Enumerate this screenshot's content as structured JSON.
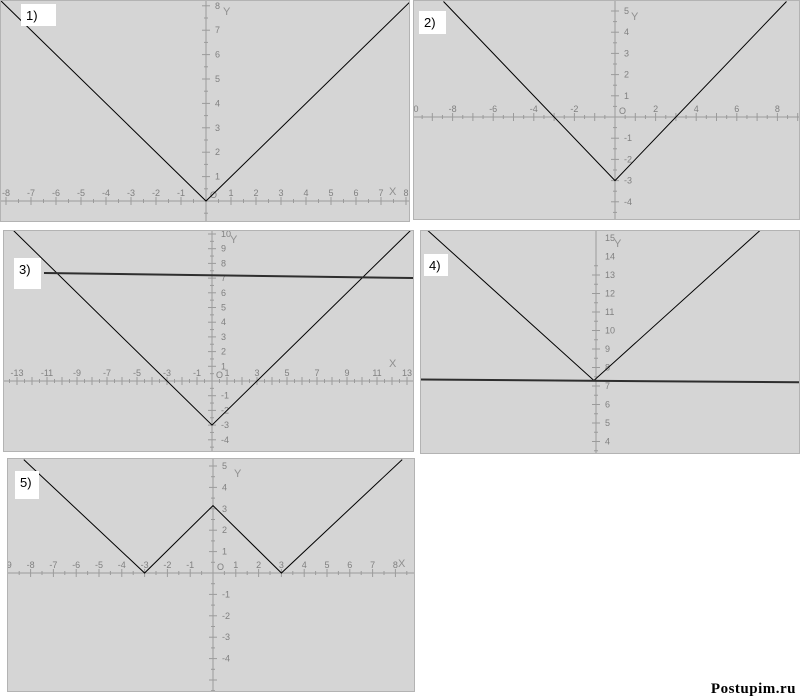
{
  "watermark": {
    "text": "Postupim.ru"
  },
  "colors": {
    "panel_bg": "#d5d5d5",
    "panel_border": "#b3b3b3",
    "axis": "#9b9b9b",
    "tick": "#9b9b9b",
    "tick_label": "#808080",
    "axis_letter": "#8f8f8f",
    "curve": "#000000",
    "thick_line": "#2e2e2e",
    "label_box_bg": "#ffffff",
    "label_text": "#000000"
  },
  "chart_data": [
    {
      "panel": "1)",
      "type": "line",
      "rect": [
        0,
        0,
        410,
        222
      ],
      "origin_px": [
        205,
        200
      ],
      "px_per_unit": [
        25,
        24.4
      ],
      "x_axis": {
        "show": true,
        "labels": [
          -8,
          -7,
          -6,
          -5,
          -4,
          -3,
          -2,
          -1,
          1,
          2,
          3,
          4,
          5,
          6,
          7,
          8
        ],
        "tick_step": 0.5,
        "letter": "X",
        "letter_px": [
          388,
          194
        ]
      },
      "y_axis": {
        "show": true,
        "labels": [
          1,
          2,
          3,
          4,
          5,
          6,
          7,
          8
        ],
        "tick_step": 0.5,
        "letter": "Y",
        "letter_px": [
          222,
          14
        ]
      },
      "origin_label": "O",
      "label_box": [
        20,
        3,
        35,
        22
      ],
      "series": [
        {
          "role": "v-curve",
          "points": [
            [
              -8.4,
              8.4
            ],
            [
              0,
              0
            ],
            [
              8.4,
              8.4
            ]
          ],
          "width": 1,
          "color": "#000000"
        }
      ]
    },
    {
      "panel": "2)",
      "type": "line",
      "rect": [
        413,
        0,
        387,
        220
      ],
      "origin_px": [
        201,
        116
      ],
      "px_per_unit": [
        20.3,
        21.2
      ],
      "x_axis": {
        "show": true,
        "labels": [
          -10,
          -8,
          -6,
          -4,
          -2,
          2,
          4,
          6,
          8
        ],
        "tick_step": 0.5,
        "letter": "",
        "letter_px": [
          0,
          0
        ]
      },
      "y_axis": {
        "show": true,
        "labels": [
          -4,
          -3,
          -2,
          -1,
          1,
          2,
          3,
          4,
          5
        ],
        "tick_step": 0.5,
        "letter": "Y",
        "letter_px": [
          217,
          19
        ]
      },
      "origin_label": "O",
      "label_box": [
        5,
        10,
        27,
        23
      ],
      "series": [
        {
          "role": "v-curve",
          "points": [
            [
              -8.45,
              5.45
            ],
            [
              0,
              -3
            ],
            [
              8.45,
              5.45
            ]
          ],
          "width": 1,
          "color": "#000000"
        }
      ]
    },
    {
      "panel": "3)",
      "type": "line",
      "rect": [
        3,
        230,
        411,
        222
      ],
      "origin_px": [
        208,
        150
      ],
      "px_per_unit": [
        15,
        14.7
      ],
      "x_axis": {
        "show": true,
        "labels": [
          -13,
          -11,
          -9,
          -7,
          -5,
          -3,
          -1,
          1,
          3,
          5,
          7,
          9,
          11,
          13
        ],
        "tick_step": 0.5,
        "letter": "X",
        "letter_px": [
          385,
          136
        ]
      },
      "y_axis": {
        "show": true,
        "labels": [
          -4,
          -3,
          -2,
          -1,
          1,
          2,
          3,
          4,
          5,
          6,
          7,
          8,
          9,
          10
        ],
        "tick_step": 0.5,
        "letter": "Y",
        "letter_px": [
          226,
          12
        ]
      },
      "origin_label": "O",
      "label_box": [
        10,
        27,
        27,
        31
      ],
      "series": [
        {
          "role": "v-curve",
          "points": [
            [
              -13.8,
              10.8
            ],
            [
              0,
              -3
            ],
            [
              13.8,
              10.8
            ]
          ],
          "width": 1,
          "color": "#000000"
        },
        {
          "role": "horizontal-line",
          "points": [
            [
              -11.2,
              7.35
            ],
            [
              13.8,
              7.0
            ]
          ],
          "width": 2,
          "color": "#2e2e2e"
        }
      ]
    },
    {
      "panel": "4)",
      "type": "line",
      "rect": [
        420,
        230,
        380,
        224
      ],
      "origin_px": [
        175,
        284.5
      ],
      "px_per_unit": [
        20.5,
        18.5
      ],
      "x_axis": {
        "show": false,
        "labels": [],
        "tick_step": 0,
        "letter": "",
        "letter_px": [
          0,
          0
        ]
      },
      "y_axis": {
        "show": true,
        "labels": [
          4,
          5,
          6,
          7,
          8,
          9,
          10,
          11,
          12,
          13,
          14,
          15
        ],
        "tick_step": 0.5,
        "letter": "Y",
        "letter_px": [
          193,
          16
        ]
      },
      "origin_label": "",
      "label_box": [
        3,
        23,
        24,
        22
      ],
      "series": [
        {
          "role": "v-curve",
          "points": [
            [
              -8.2,
              15.4
            ],
            [
              -0.1,
              7.3
            ],
            [
              8.1,
              15.5
            ]
          ],
          "width": 1,
          "color": "#000000"
        },
        {
          "role": "horizontal-line",
          "points": [
            [
              -8.6,
              7.35
            ],
            [
              10.1,
              7.2
            ]
          ],
          "width": 2,
          "color": "#2e2e2e"
        }
      ]
    },
    {
      "panel": "5)",
      "type": "line",
      "rect": [
        7,
        458,
        408,
        234
      ],
      "origin_px": [
        205,
        114
      ],
      "px_per_unit": [
        22.8,
        21.4
      ],
      "x_axis": {
        "show": true,
        "labels": [
          -9,
          -8,
          -7,
          -6,
          -5,
          -4,
          -3,
          -2,
          -1,
          1,
          2,
          3,
          4,
          5,
          6,
          7,
          8,
          9
        ],
        "tick_step": 0.5,
        "letter": "X",
        "letter_px": [
          390,
          108
        ]
      },
      "y_axis": {
        "show": true,
        "labels": [
          -4,
          -3,
          -2,
          -1,
          1,
          2,
          3,
          4,
          5
        ],
        "tick_step": 0.5,
        "letter": "Y",
        "letter_px": [
          226,
          18
        ]
      },
      "origin_label": "O",
      "label_box": [
        7,
        12,
        24,
        28
      ],
      "series": [
        {
          "role": "w-curve",
          "points": [
            [
              -8.3,
              5.3
            ],
            [
              -3,
              0
            ],
            [
              0,
              3.15
            ],
            [
              3,
              0
            ],
            [
              8.3,
              5.3
            ]
          ],
          "width": 1,
          "color": "#000000"
        }
      ]
    }
  ]
}
